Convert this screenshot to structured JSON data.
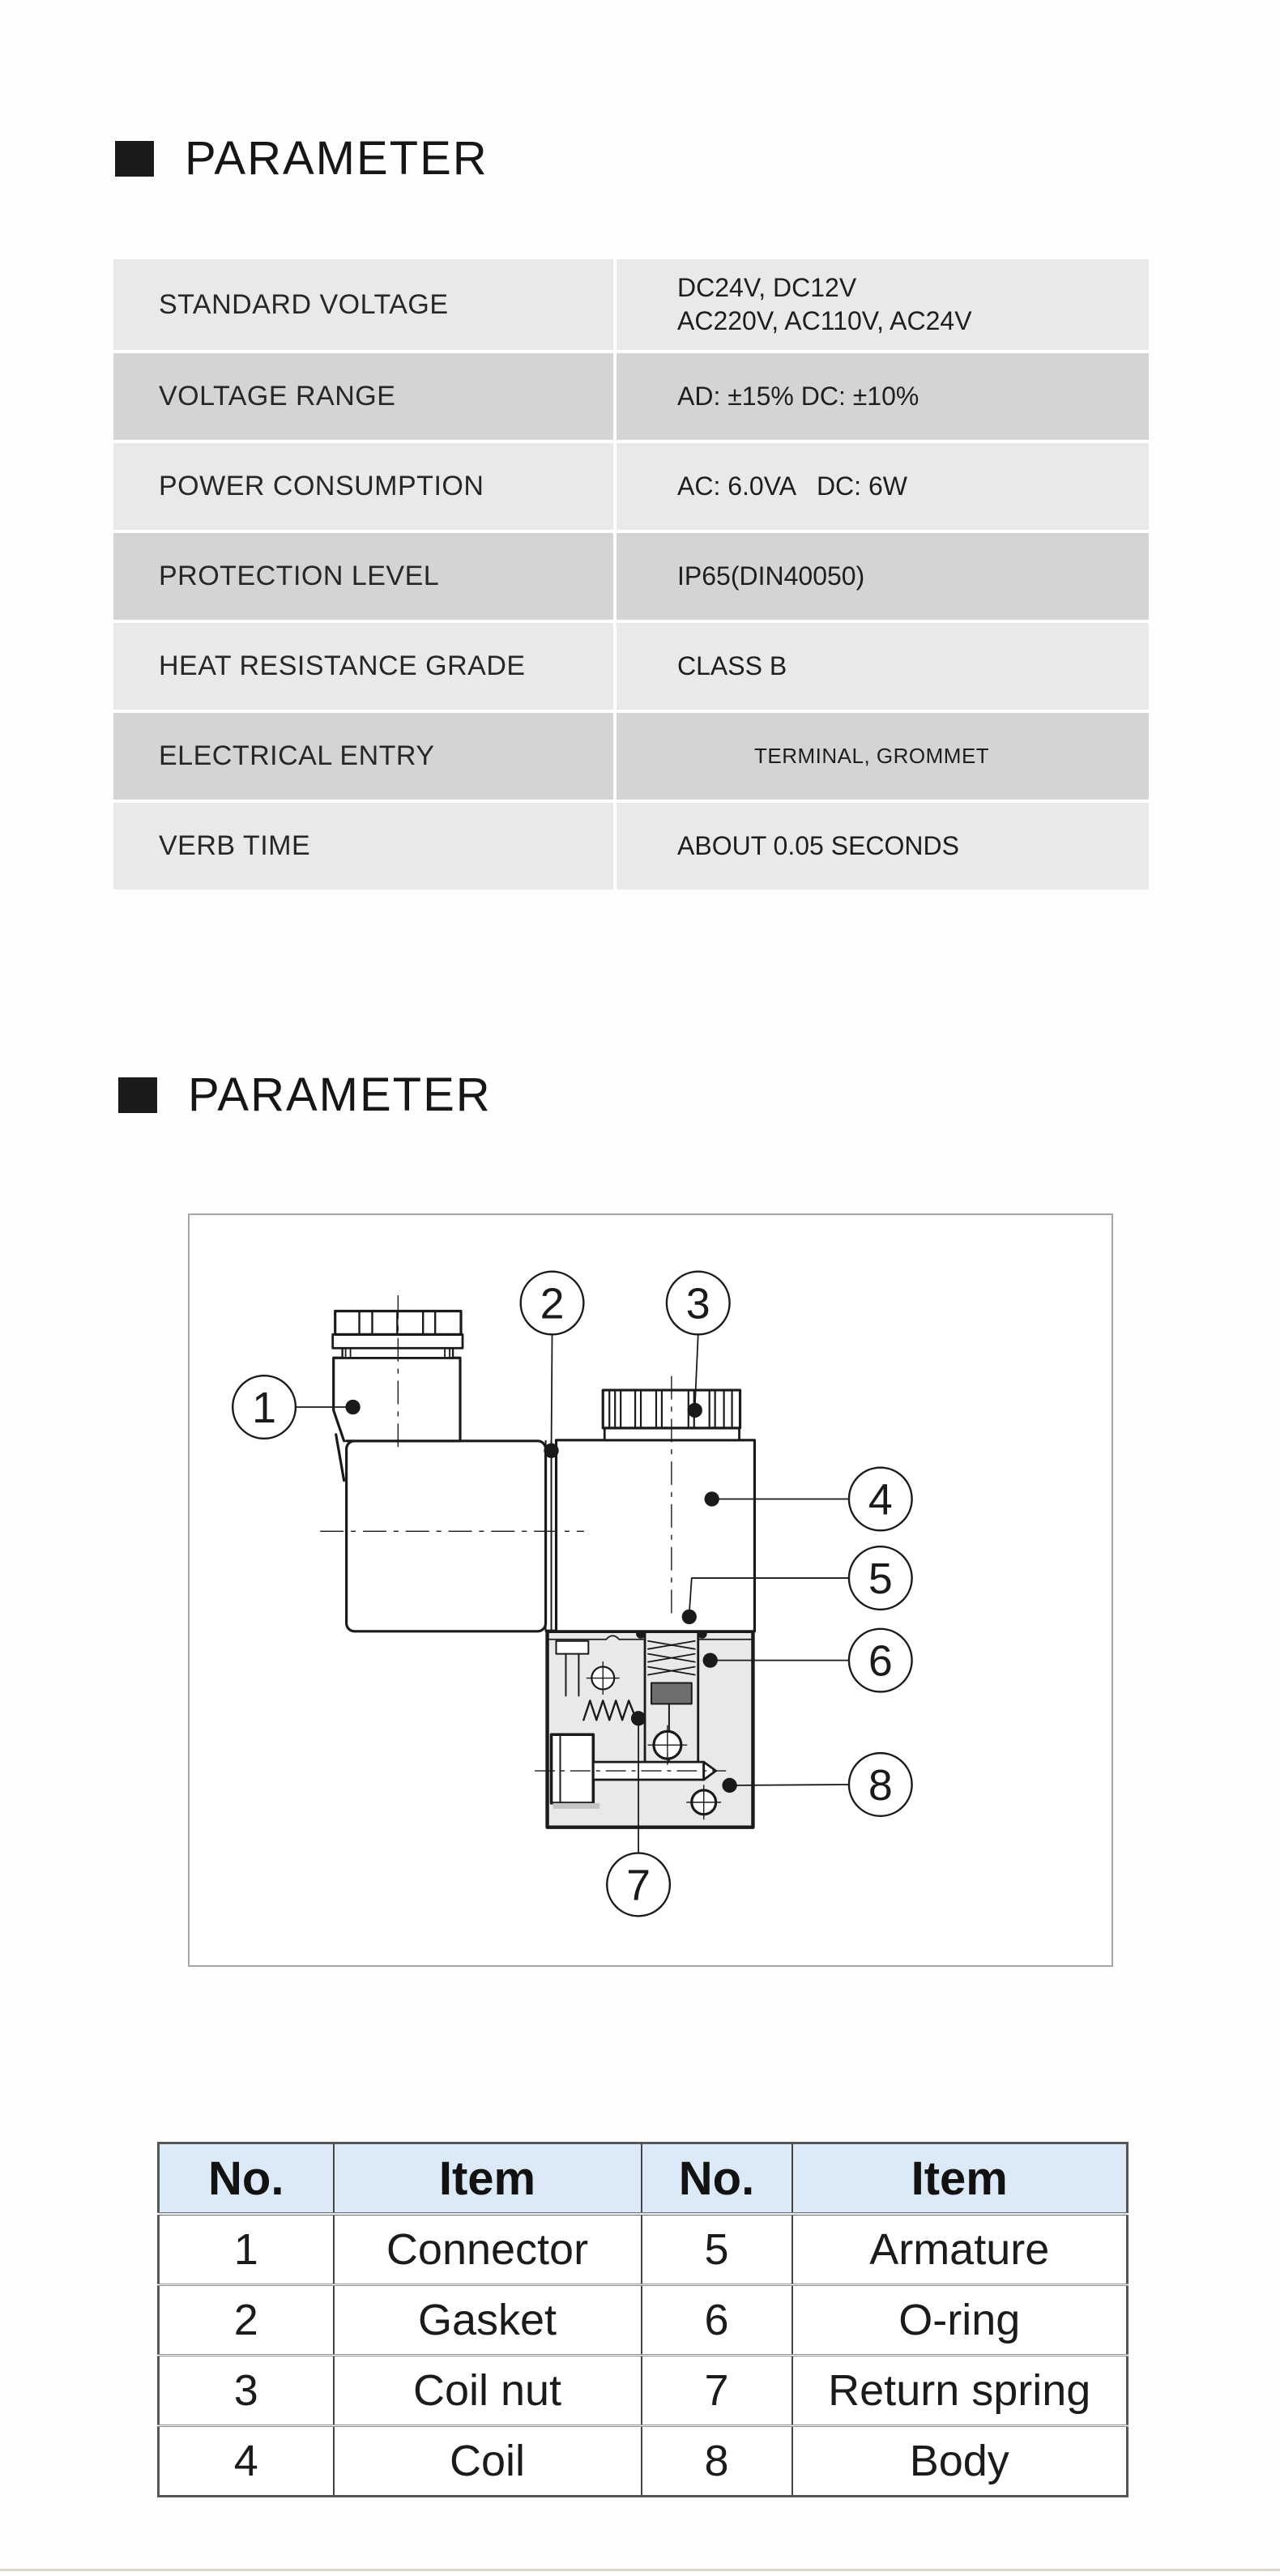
{
  "headings": [
    {
      "text": "PARAMETER"
    },
    {
      "text": "PARAMETER"
    }
  ],
  "spec_table": {
    "rows": [
      {
        "label": "STANDARD VOLTAGE",
        "value_lines": [
          "DC24V, DC12V",
          "AC220V, AC110V, AC24V"
        ]
      },
      {
        "label": "VOLTAGE RANGE",
        "value_lines": [
          "AD: ±15% DC: ±10%"
        ]
      },
      {
        "label": "POWER CONSUMPTION",
        "value_lines": [
          "AC: 6.0VA   DC: 6W"
        ]
      },
      {
        "label": "PROTECTION LEVEL",
        "value_lines": [
          "IP65(DIN40050)"
        ]
      },
      {
        "label": "HEAT RESISTANCE GRADE",
        "value_lines": [
          "CLASS B"
        ]
      },
      {
        "label": "ELECTRICAL ENTRY",
        "value_lines": [
          "TERMINAL, GROMMET"
        ]
      },
      {
        "label": "VERB TIME",
        "value_lines": [
          "ABOUT 0.05 SECONDS"
        ]
      }
    ]
  },
  "diagram": {
    "callouts": [
      "1",
      "2",
      "3",
      "4",
      "5",
      "6",
      "7",
      "8"
    ]
  },
  "parts_table": {
    "headers": [
      "No.",
      "Item",
      "No.",
      "Item"
    ],
    "rows": [
      [
        "1",
        "Connector",
        "5",
        "Armature"
      ],
      [
        "2",
        "Gasket",
        "6",
        "O-ring"
      ],
      [
        "3",
        "Coil nut",
        "7",
        "Return spring"
      ],
      [
        "4",
        "Coil",
        "8",
        "Body"
      ]
    ]
  },
  "colors": {
    "header_square": "#1b1b1c",
    "table_row_light": "#e9e9e8",
    "table_row_dark": "#d3d5d4",
    "parts_header_bg": "#dce9f6",
    "line": "#1a1a1a",
    "body_fill": "#e9e9e9",
    "footer_rule": "#dcd7ce"
  }
}
